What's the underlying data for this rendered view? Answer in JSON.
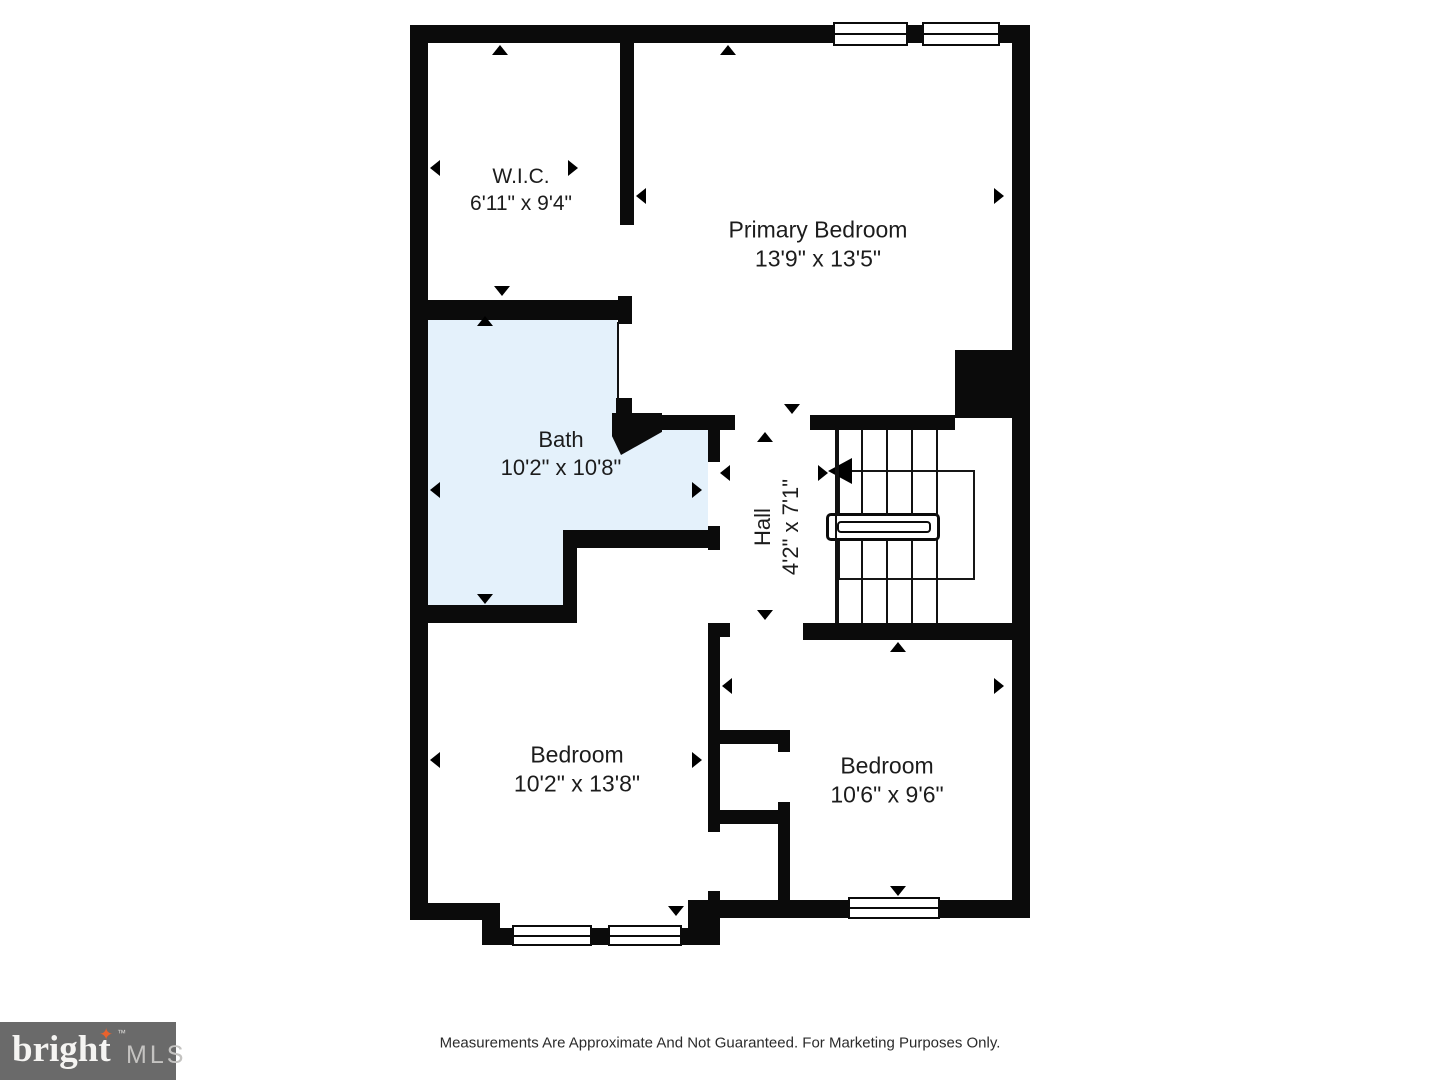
{
  "rooms": {
    "wic": {
      "name": "W.I.C.",
      "dims": "6'11\" x 9'4\""
    },
    "primary": {
      "name": "Primary Bedroom",
      "dims": "13'9\" x 13'5\""
    },
    "bath": {
      "name": "Bath",
      "dims": "10'2\" x 10'8\""
    },
    "hall": {
      "name": "Hall",
      "dims": "4'2\" x 7'1\""
    },
    "bedroom_left": {
      "name": "Bedroom",
      "dims": "10'2\" x 13'8\""
    },
    "bedroom_right": {
      "name": "Bedroom",
      "dims": "10'6\" x 9'6\""
    }
  },
  "footer": {
    "disclaimer": "Measurements Are Approximate And Not Guaranteed. For Marketing Purposes Only."
  },
  "logo": {
    "brand": "bright",
    "suffix": "MLS",
    "trademark": "™",
    "star_icon": "four-point-star"
  },
  "colors": {
    "wall": "#0b0b0b",
    "bath_fill": "#e4f1fb",
    "logo_bg": "#6a6a6a",
    "logo_brand": "#f5f4f2",
    "logo_star": "#e8622d",
    "logo_suffix": "#c4c3c1"
  }
}
